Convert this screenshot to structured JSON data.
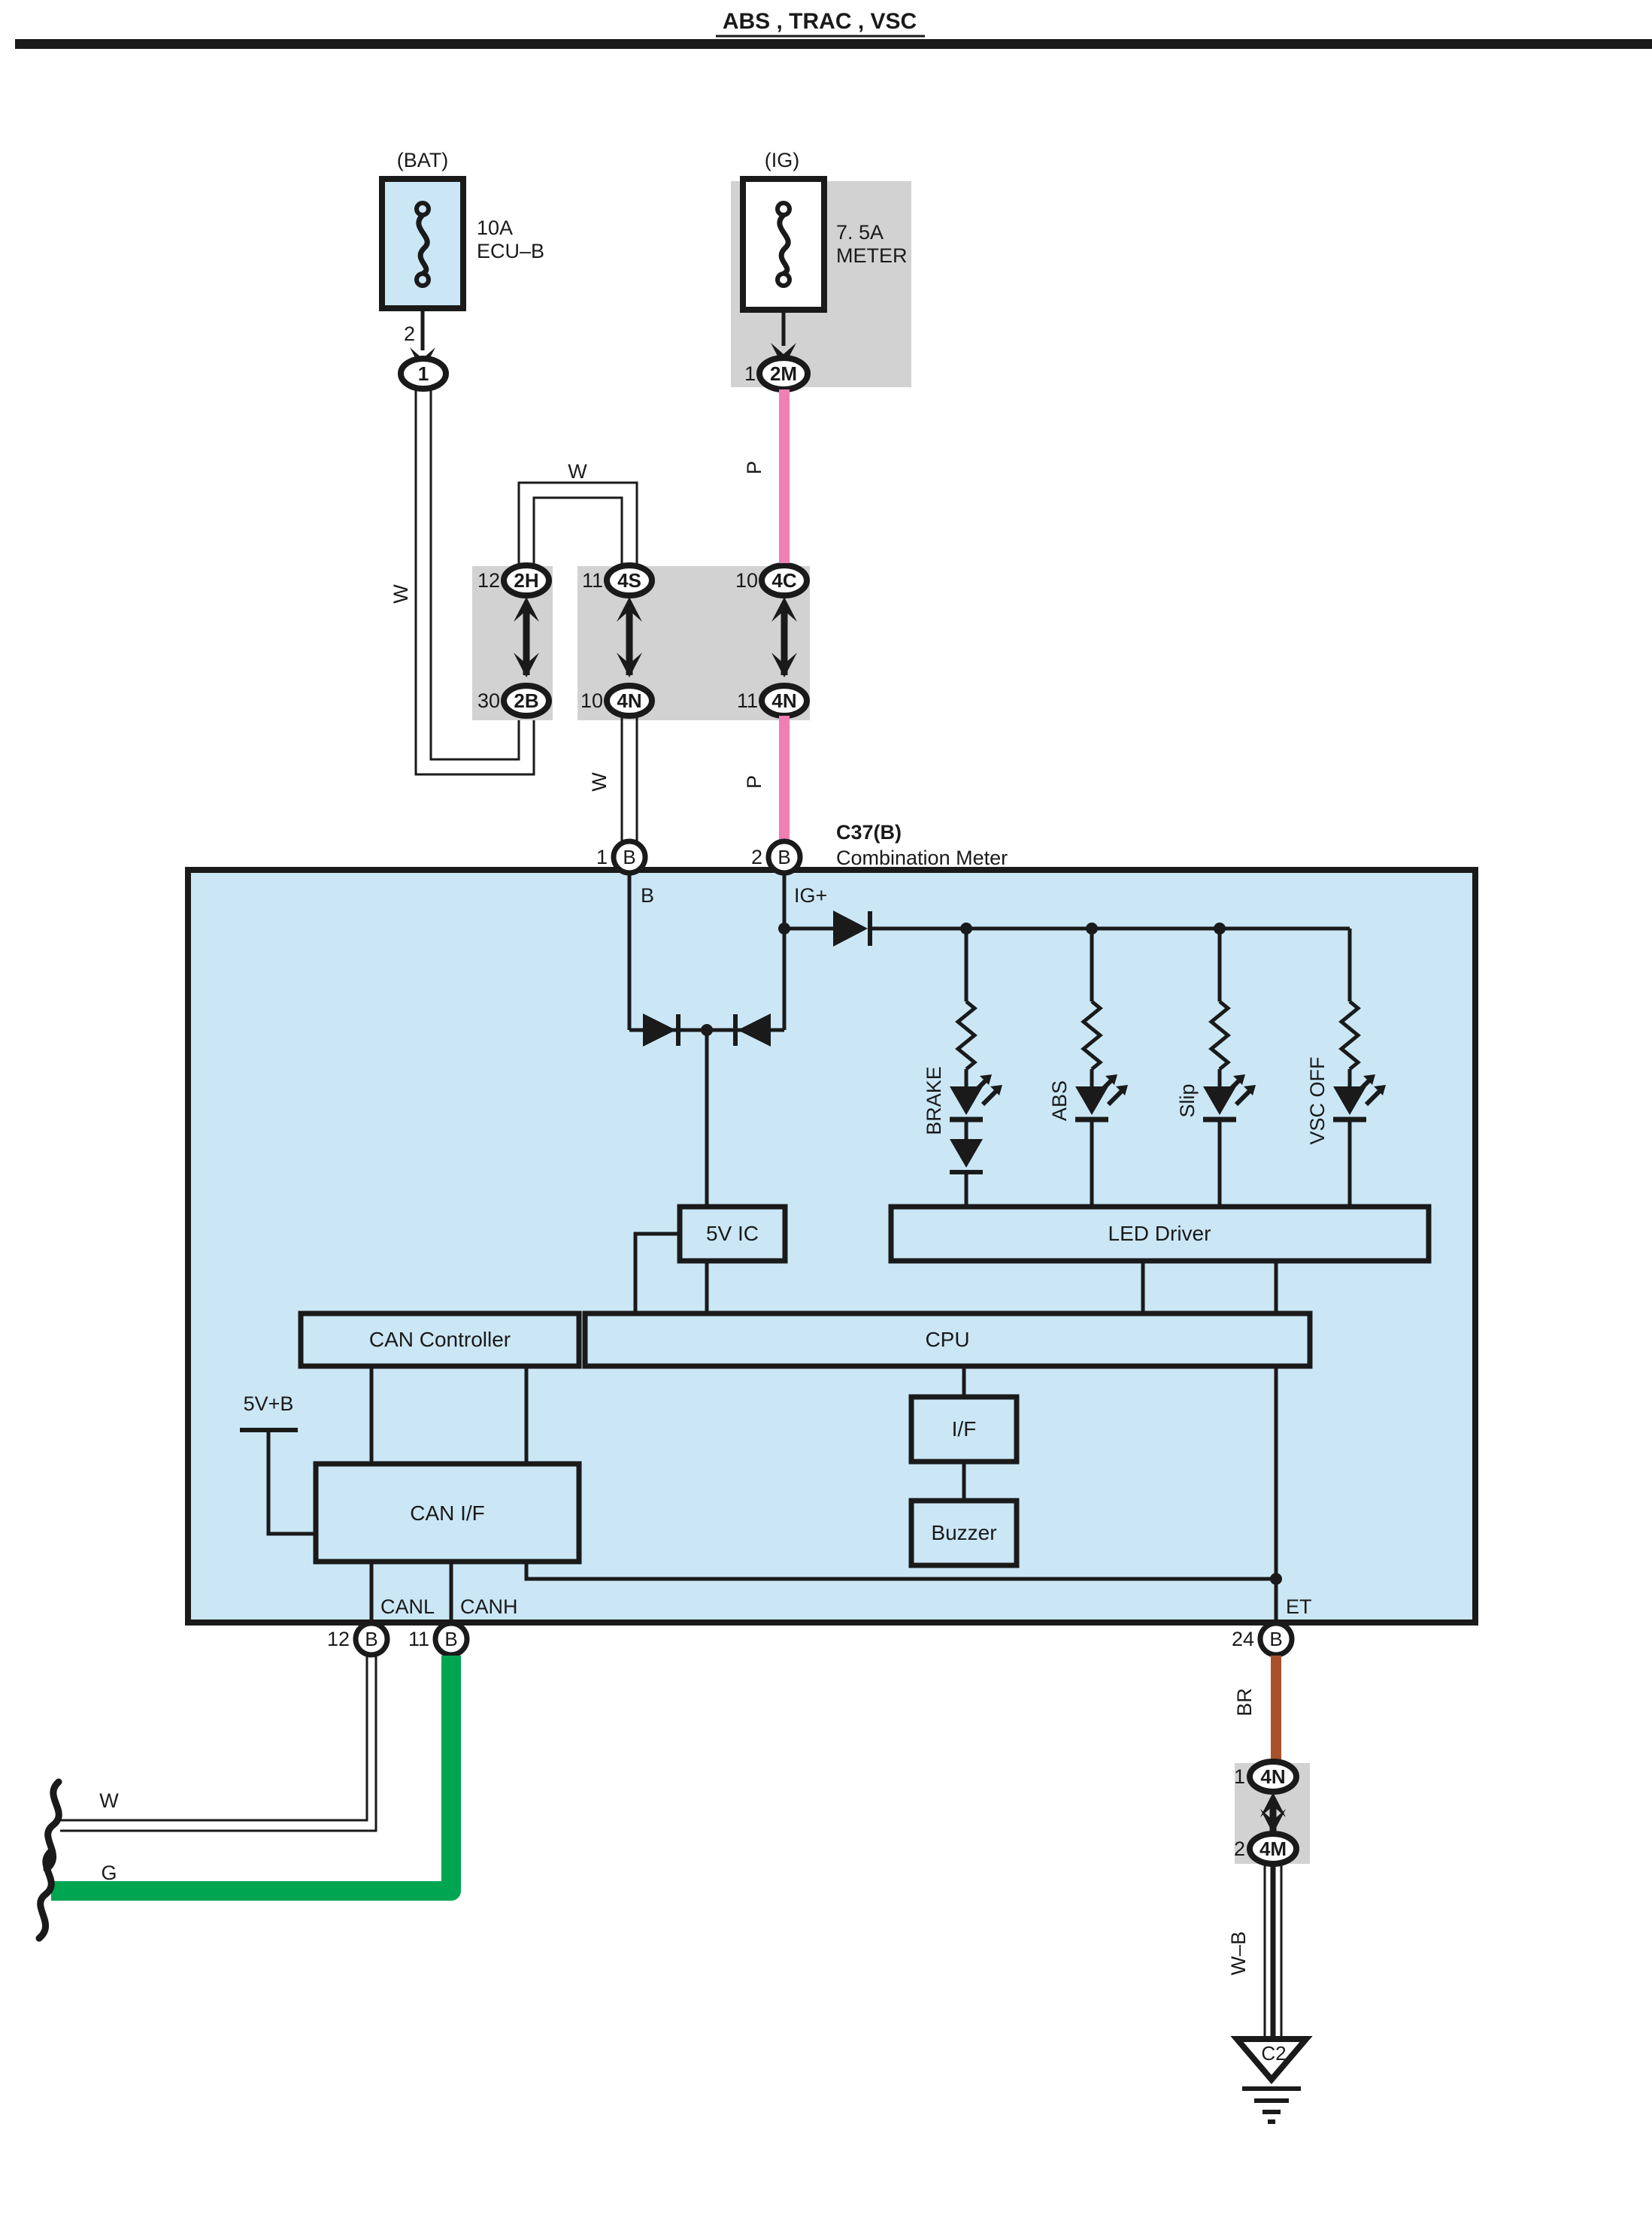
{
  "title": "ABS , TRAC , VSC",
  "colors": {
    "panel_blue": "#cbe7f6",
    "gray": "#d2d2d2",
    "pink": "#f07fb2",
    "green": "#00a551",
    "brown": "#a8522d",
    "line": "#1a1a1a"
  },
  "fuses": {
    "bat": {
      "tag": "(BAT)",
      "rating": "10A",
      "name": "ECU–B",
      "pin_out": "2",
      "connector": "1"
    },
    "ig": {
      "tag": "(IG)",
      "rating": "7. 5A",
      "name": "METER",
      "pin_out": "1",
      "connector": "2M"
    }
  },
  "junction_connectors": {
    "c2h": {
      "pin": "12",
      "id": "2H"
    },
    "c2b": {
      "pin": "30",
      "id": "2B"
    },
    "c4s": {
      "pin": "11",
      "id": "4S"
    },
    "c4n1": {
      "pin": "10",
      "id": "4N"
    },
    "c4c": {
      "pin": "10",
      "id": "4C"
    },
    "c4n2": {
      "pin": "11",
      "id": "4N"
    },
    "c4n3": {
      "pin": "1",
      "id": "4N"
    },
    "c4m": {
      "pin": "2",
      "id": "4M"
    }
  },
  "wires": {
    "w_bat": "W",
    "w_jump": "W",
    "w_mid": "W",
    "p_top": "P",
    "p_mid": "P",
    "w_can": "W",
    "g_can": "G",
    "br": "BR",
    "wb": "W–B"
  },
  "meter": {
    "code": "C37(B)",
    "name": "Combination Meter",
    "pins": {
      "b": {
        "num": "1",
        "id": "B",
        "label": "B"
      },
      "ig": {
        "num": "2",
        "id": "B",
        "label": "IG+"
      },
      "canl": {
        "num": "12",
        "id": "B",
        "label": "CANL"
      },
      "canh": {
        "num": "11",
        "id": "B",
        "label": "CANH"
      },
      "et": {
        "num": "24",
        "id": "B",
        "label": "ET"
      }
    },
    "blocks": {
      "ic5v": "5V IC",
      "led_driver": "LED Driver",
      "can_controller": "CAN Controller",
      "cpu": "CPU",
      "if": "I/F",
      "buzzer": "Buzzer",
      "can_if": "CAN I/F"
    },
    "indicators": [
      "BRAKE",
      "ABS",
      "Slip",
      "VSC OFF"
    ],
    "labels": {
      "v5b": "5V+B"
    }
  },
  "ground": {
    "id": "C2"
  }
}
